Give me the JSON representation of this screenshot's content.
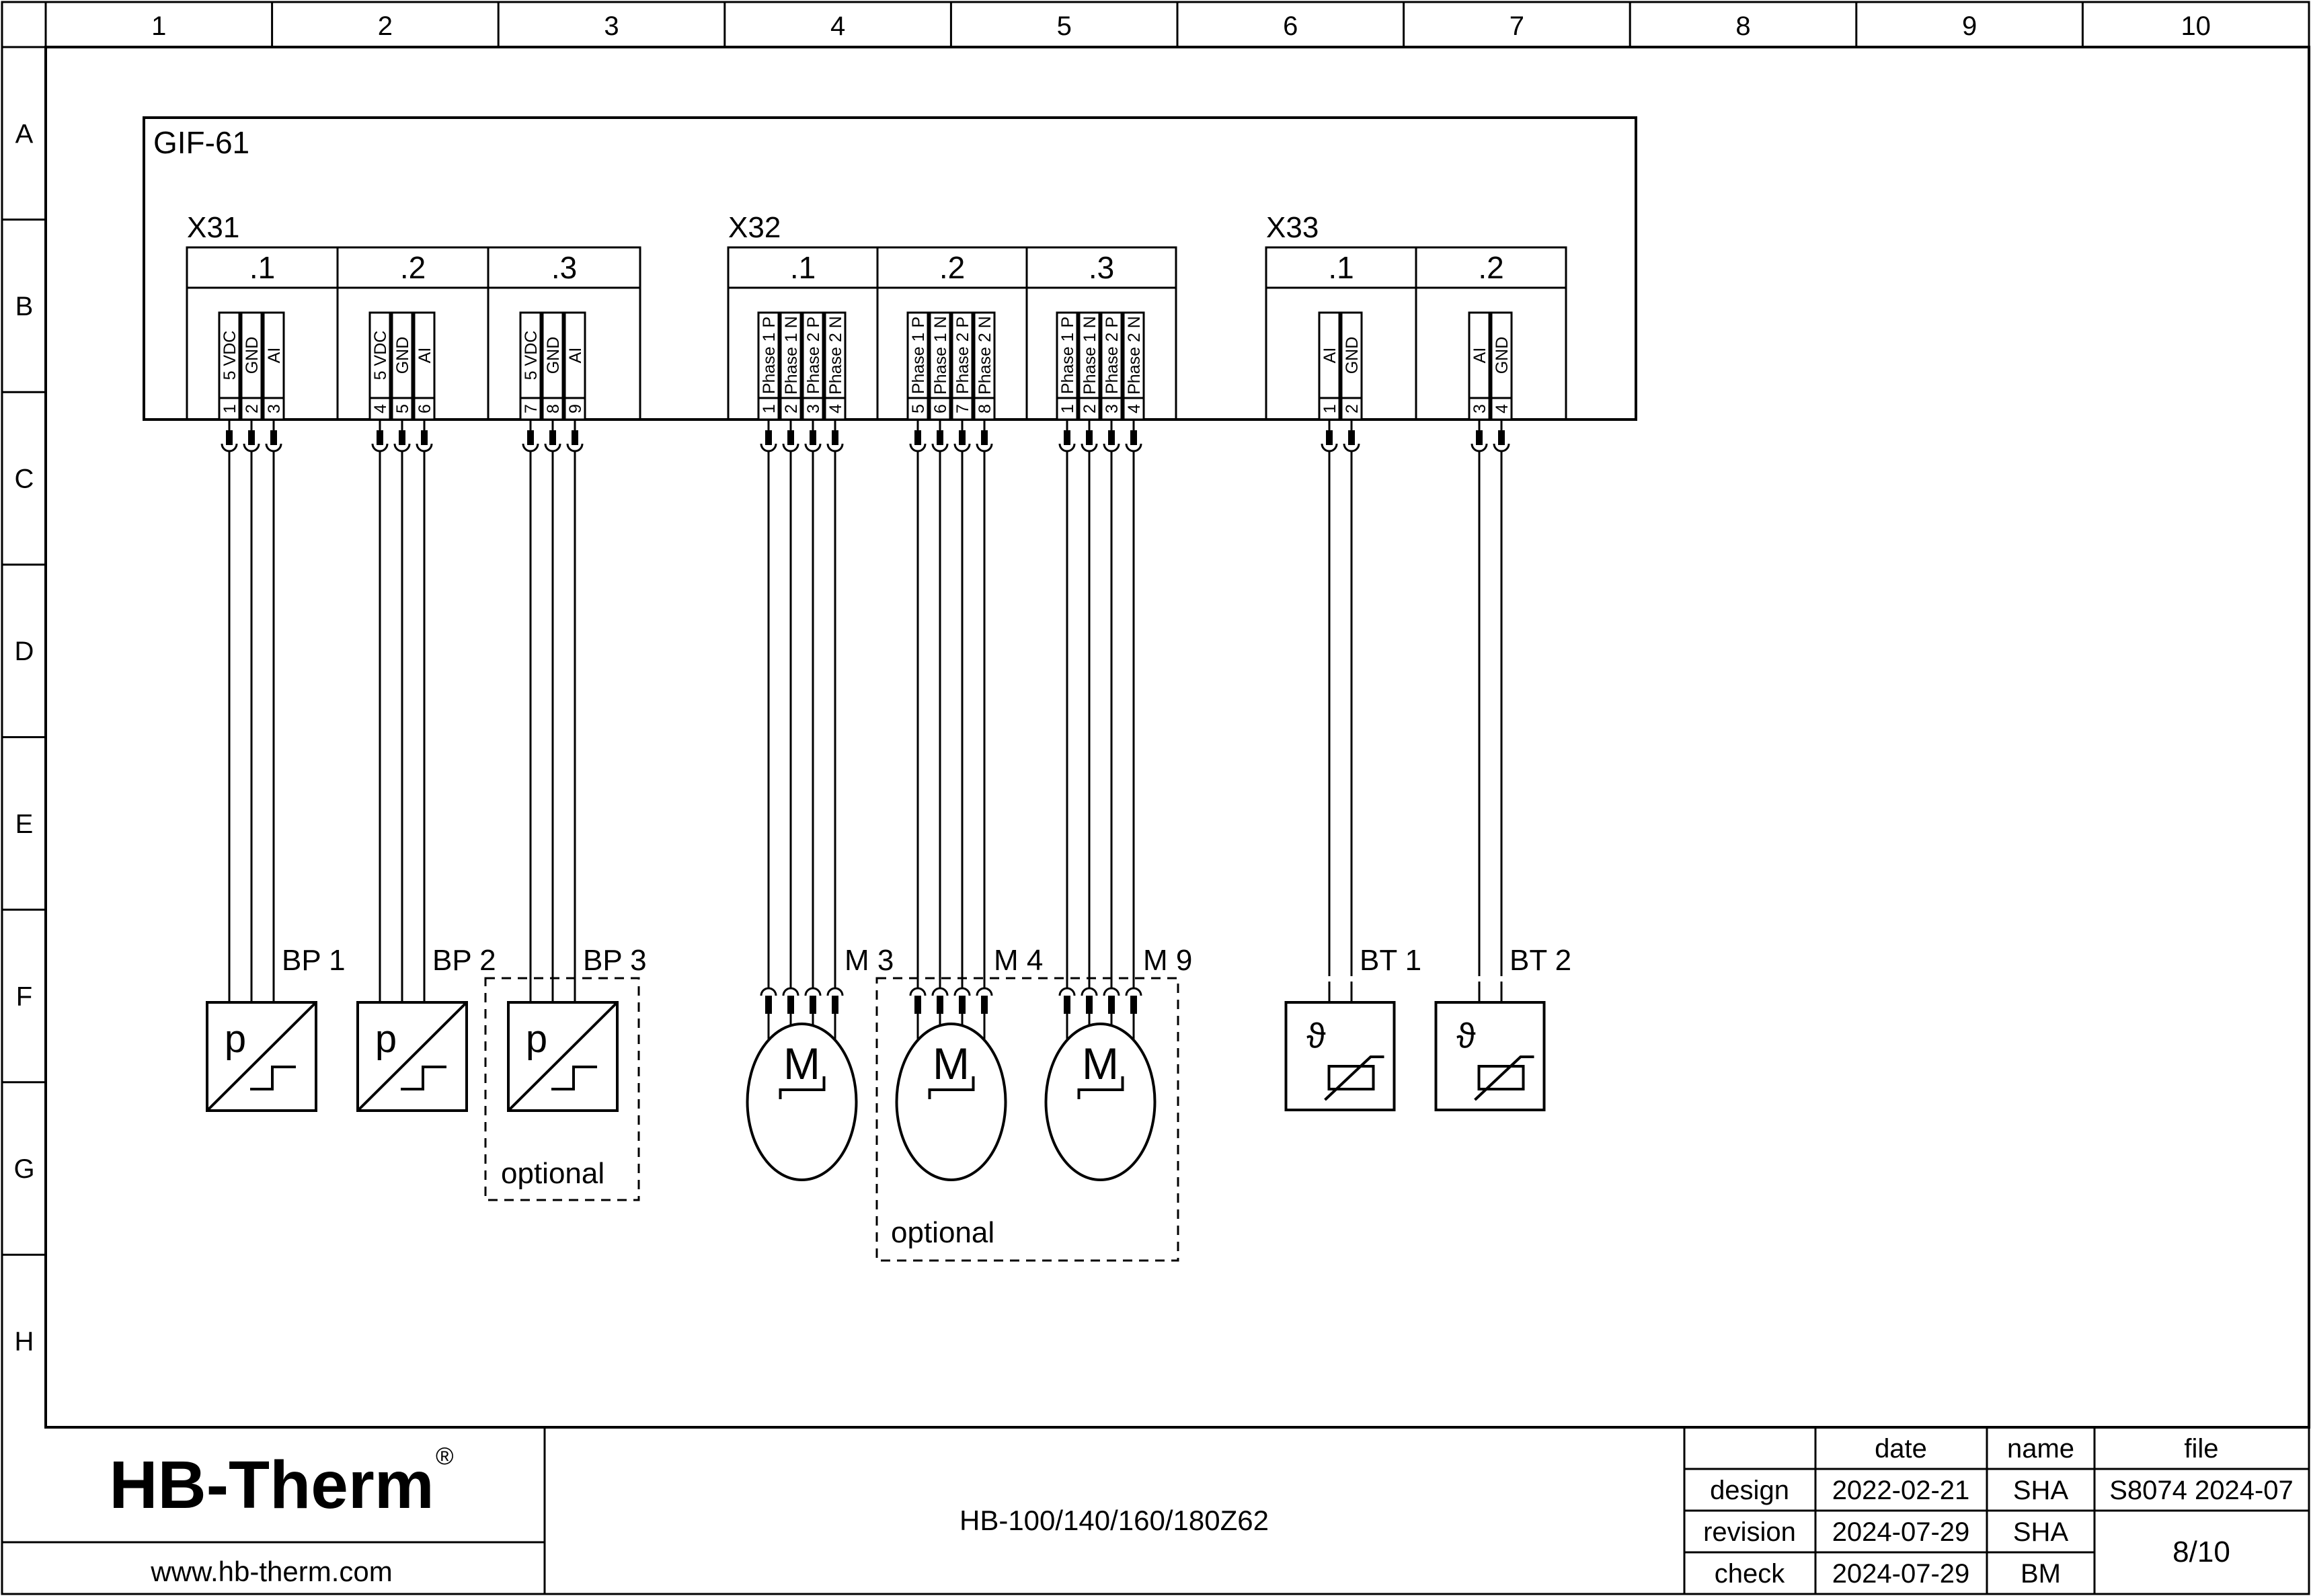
{
  "frame": {
    "columns": [
      "1",
      "2",
      "3",
      "4",
      "5",
      "6",
      "7",
      "8",
      "9",
      "10"
    ],
    "rows": [
      "A",
      "B",
      "C",
      "D",
      "E",
      "F",
      "G",
      "H"
    ]
  },
  "device": {
    "label": "GIF-61"
  },
  "connectors": [
    {
      "label": "X31",
      "cells": [
        {
          "label": ".1",
          "pins": [
            {
              "num": "1",
              "signal": "5 VDC"
            },
            {
              "num": "2",
              "signal": "GND"
            },
            {
              "num": "3",
              "signal": "AI"
            }
          ]
        },
        {
          "label": ".2",
          "pins": [
            {
              "num": "4",
              "signal": "5 VDC"
            },
            {
              "num": "5",
              "signal": "GND"
            },
            {
              "num": "6",
              "signal": "AI"
            }
          ]
        },
        {
          "label": ".3",
          "pins": [
            {
              "num": "7",
              "signal": "5 VDC"
            },
            {
              "num": "8",
              "signal": "GND"
            },
            {
              "num": "9",
              "signal": "AI"
            }
          ]
        }
      ]
    },
    {
      "label": "X32",
      "cells": [
        {
          "label": ".1",
          "pins": [
            {
              "num": "1",
              "signal": "Phase 1 P"
            },
            {
              "num": "2",
              "signal": "Phase 1 N"
            },
            {
              "num": "3",
              "signal": "Phase 2 P"
            },
            {
              "num": "4",
              "signal": "Phase 2 N"
            }
          ]
        },
        {
          "label": ".2",
          "pins": [
            {
              "num": "5",
              "signal": "Phase 1 P"
            },
            {
              "num": "6",
              "signal": "Phase 1 N"
            },
            {
              "num": "7",
              "signal": "Phase 2 P"
            },
            {
              "num": "8",
              "signal": "Phase 2 N"
            }
          ]
        },
        {
          "label": ".3",
          "pins": [
            {
              "num": "1",
              "signal": "Phase 1 P"
            },
            {
              "num": "2",
              "signal": "Phase 1 N"
            },
            {
              "num": "3",
              "signal": "Phase 2 P"
            },
            {
              "num": "4",
              "signal": "Phase 2 N"
            }
          ]
        }
      ]
    },
    {
      "label": "X33",
      "cells": [
        {
          "label": ".1",
          "pins": [
            {
              "num": "1",
              "signal": "AI"
            },
            {
              "num": "2",
              "signal": "GND"
            }
          ]
        },
        {
          "label": ".2",
          "pins": [
            {
              "num": "3",
              "signal": "AI"
            },
            {
              "num": "4",
              "signal": "GND"
            }
          ]
        }
      ]
    }
  ],
  "components": [
    {
      "id": "bp1",
      "label": "BP 1",
      "type": "pressure-sensor",
      "symbol": "p"
    },
    {
      "id": "bp2",
      "label": "BP 2",
      "type": "pressure-sensor",
      "symbol": "p"
    },
    {
      "id": "bp3",
      "label": "BP 3",
      "type": "pressure-sensor",
      "symbol": "p",
      "optional": "optional"
    },
    {
      "id": "m3",
      "label": "M 3",
      "type": "motor",
      "symbol": "M"
    },
    {
      "id": "m4",
      "label": "M 4",
      "type": "motor",
      "symbol": "M",
      "optional_group": true
    },
    {
      "id": "m9",
      "label": "M 9",
      "type": "motor",
      "symbol": "M",
      "optional_group": true
    },
    {
      "id": "bt1",
      "label": "BT 1",
      "type": "temperature-sensor",
      "symbol": "ϑ"
    },
    {
      "id": "bt2",
      "label": "BT 2",
      "type": "temperature-sensor",
      "symbol": "ϑ"
    }
  ],
  "optional_motor_label": "optional",
  "title_block": {
    "logo": "HB-Therm",
    "logo_registered": "®",
    "logo_color": "#1b2a4c",
    "website": "www.hb-therm.com",
    "drawing_title": "HB-100/140/160/180Z62",
    "table": {
      "headers": [
        "date",
        "name",
        "file"
      ],
      "rows": [
        {
          "label": "design",
          "date": "2022-02-21",
          "name": "SHA"
        },
        {
          "label": "revision",
          "date": "2024-07-29",
          "name": "SHA"
        },
        {
          "label": "check",
          "date": "2024-07-29",
          "name": "BM"
        }
      ],
      "file_value": "S8074 2024-07",
      "page": "8/10"
    }
  }
}
